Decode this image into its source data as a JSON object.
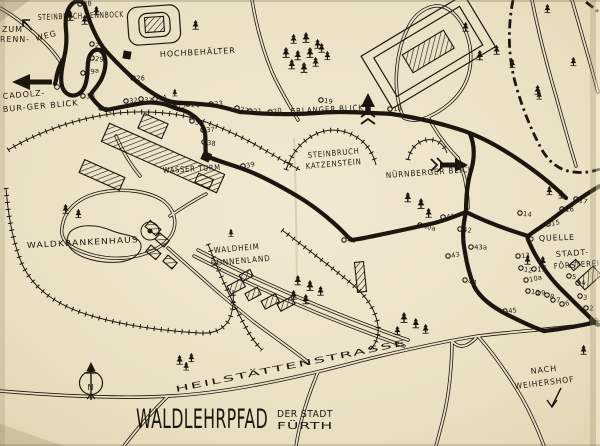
{
  "map": {
    "paper_color": "#ebe2c6",
    "ink_color": "#1d160f",
    "title": "WALDLEHRPFAD",
    "title_suffix_line1": "DER STADT",
    "title_suffix_line2": "FÜRTH",
    "compass_north": "N",
    "labels": {
      "steinbruch_rennbock": "STEINBRUCH RENNBOCK",
      "zum": "ZUM",
      "renn": "RENN-",
      "weg": "WEG",
      "hochbehaelter": "HOCHBEHÄLTER",
      "cadolzburger_line1": "CADOLZ-",
      "cadolzburger_line2": "BUR-GER BLICK",
      "erlanger_blick": "ERLANGER BLICK",
      "katzenstein_line1": "STEINBRUCH",
      "katzenstein_line2": "KATZENSTEIN",
      "nuernberger_blick": "NÜRNBERGER BLICK",
      "wasserturm": "WASSER TURM",
      "waldkrankenhaus": "WALDKRANKENHAUS",
      "waldheim_line1": "WALDHEIM",
      "waldheim_line2": "SONNENLAND",
      "quelle": "QUELLE",
      "stadtfoersterei_line1": "STADT-",
      "stadtfoersterei_line2": "FÖRSTEREI",
      "heilstaettenstrasse": "HEILSTÄTTENSTRASSE",
      "nach": "NACH",
      "weihershof": "WEIHERSHOF"
    },
    "stations": [
      {
        "n": "1",
        "x": 592,
        "y": 321
      },
      {
        "n": "2",
        "x": 586,
        "y": 308
      },
      {
        "n": "3",
        "x": 580,
        "y": 296
      },
      {
        "n": "4",
        "x": 578,
        "y": 283
      },
      {
        "n": "5",
        "x": 569,
        "y": 276
      },
      {
        "n": "6",
        "x": 562,
        "y": 304
      },
      {
        "n": "7",
        "x": 553,
        "y": 300
      },
      {
        "n": "8",
        "x": 547,
        "y": 295
      },
      {
        "n": "9",
        "x": 538,
        "y": 293
      },
      {
        "n": "10",
        "x": 528,
        "y": 291
      },
      {
        "n": "10a",
        "x": 526,
        "y": 280
      },
      {
        "n": "11",
        "x": 534,
        "y": 269
      },
      {
        "n": "12",
        "x": 521,
        "y": 268
      },
      {
        "n": "13",
        "x": 518,
        "y": 256
      },
      {
        "n": "14",
        "x": 520,
        "y": 213
      },
      {
        "n": "15",
        "x": 548,
        "y": 224
      },
      {
        "n": "16",
        "x": 562,
        "y": 209
      },
      {
        "n": "17",
        "x": 576,
        "y": 199
      },
      {
        "n": "18",
        "x": 390,
        "y": 109
      },
      {
        "n": "19",
        "x": 321,
        "y": 100
      },
      {
        "n": "20",
        "x": 270,
        "y": 112
      },
      {
        "n": "21",
        "x": 250,
        "y": 111
      },
      {
        "n": "22",
        "x": 237,
        "y": 108
      },
      {
        "n": "23",
        "x": 211,
        "y": 104
      },
      {
        "n": "24",
        "x": 188,
        "y": 104
      },
      {
        "n": "25",
        "x": 174,
        "y": 107
      },
      {
        "n": "26",
        "x": 133,
        "y": 78
      },
      {
        "n": "27",
        "x": 92,
        "y": 44
      },
      {
        "n": "28",
        "x": 80,
        "y": 4
      },
      {
        "n": "29",
        "x": 92,
        "y": 58
      },
      {
        "n": "29a",
        "x": 83,
        "y": 73
      },
      {
        "n": "30",
        "x": 83,
        "y": 96
      },
      {
        "n": "31",
        "x": 101,
        "y": 108
      },
      {
        "n": "32",
        "x": 126,
        "y": 101
      },
      {
        "n": "33",
        "x": 141,
        "y": 99
      },
      {
        "n": "34",
        "x": 155,
        "y": 99
      },
      {
        "n": "35",
        "x": 167,
        "y": 103
      },
      {
        "n": "36",
        "x": 192,
        "y": 121
      },
      {
        "n": "37",
        "x": 203,
        "y": 130
      },
      {
        "n": "38",
        "x": 204,
        "y": 142
      },
      {
        "n": "39",
        "x": 243,
        "y": 166
      },
      {
        "n": "40",
        "x": 344,
        "y": 240
      },
      {
        "n": "40a",
        "x": 420,
        "y": 225
      },
      {
        "n": "41",
        "x": 443,
        "y": 217
      },
      {
        "n": "42",
        "x": 460,
        "y": 229
      },
      {
        "n": "43",
        "x": 448,
        "y": 256
      },
      {
        "n": "43a",
        "x": 471,
        "y": 247
      },
      {
        "n": "44",
        "x": 465,
        "y": 280
      },
      {
        "n": "45",
        "x": 505,
        "y": 311
      }
    ],
    "trees": [
      [
        70,
        16,
        1
      ],
      [
        85,
        21,
        0.9
      ],
      [
        97,
        12,
        0.85
      ],
      [
        196,
        26,
        0.9
      ],
      [
        294,
        40,
        0.9
      ],
      [
        306,
        38,
        1
      ],
      [
        318,
        45,
        0.9
      ],
      [
        286,
        53,
        1
      ],
      [
        298,
        56,
        0.95
      ],
      [
        310,
        53,
        1
      ],
      [
        322,
        49,
        0.9
      ],
      [
        292,
        65,
        0.95
      ],
      [
        304,
        68,
        1
      ],
      [
        316,
        63,
        0.9
      ],
      [
        328,
        57,
        0.85
      ],
      [
        466,
        28,
        0.9
      ],
      [
        548,
        10,
        0.85
      ],
      [
        480,
        56,
        0.95
      ],
      [
        497,
        51,
        0.9
      ],
      [
        513,
        65,
        0.85
      ],
      [
        538,
        91,
        0.9
      ],
      [
        574,
        63,
        0.85
      ],
      [
        540,
        97,
        0.8
      ],
      [
        408,
        198,
        0.95
      ],
      [
        421,
        204,
        1
      ],
      [
        429,
        214,
        0.9
      ],
      [
        528,
        261,
        0.9
      ],
      [
        543,
        262,
        0.95
      ],
      [
        550,
        192,
        0.85
      ],
      [
        562,
        196,
        0.8
      ],
      [
        66,
        210,
        0.9
      ],
      [
        79,
        215,
        0.85
      ],
      [
        298,
        281,
        0.95
      ],
      [
        310,
        286,
        1
      ],
      [
        321,
        292,
        0.9
      ],
      [
        294,
        296,
        0.9
      ],
      [
        306,
        300,
        0.95
      ],
      [
        404,
        318,
        1
      ],
      [
        416,
        324,
        0.95
      ],
      [
        426,
        330,
        0.9
      ],
      [
        398,
        332,
        0.85
      ],
      [
        180,
        361,
        0.9
      ],
      [
        192,
        359,
        0.85
      ],
      [
        187,
        368,
        0.8
      ],
      [
        584,
        351,
        0.9
      ],
      [
        176,
        95,
        0.7
      ],
      [
        232,
        235,
        0.75
      ]
    ]
  }
}
